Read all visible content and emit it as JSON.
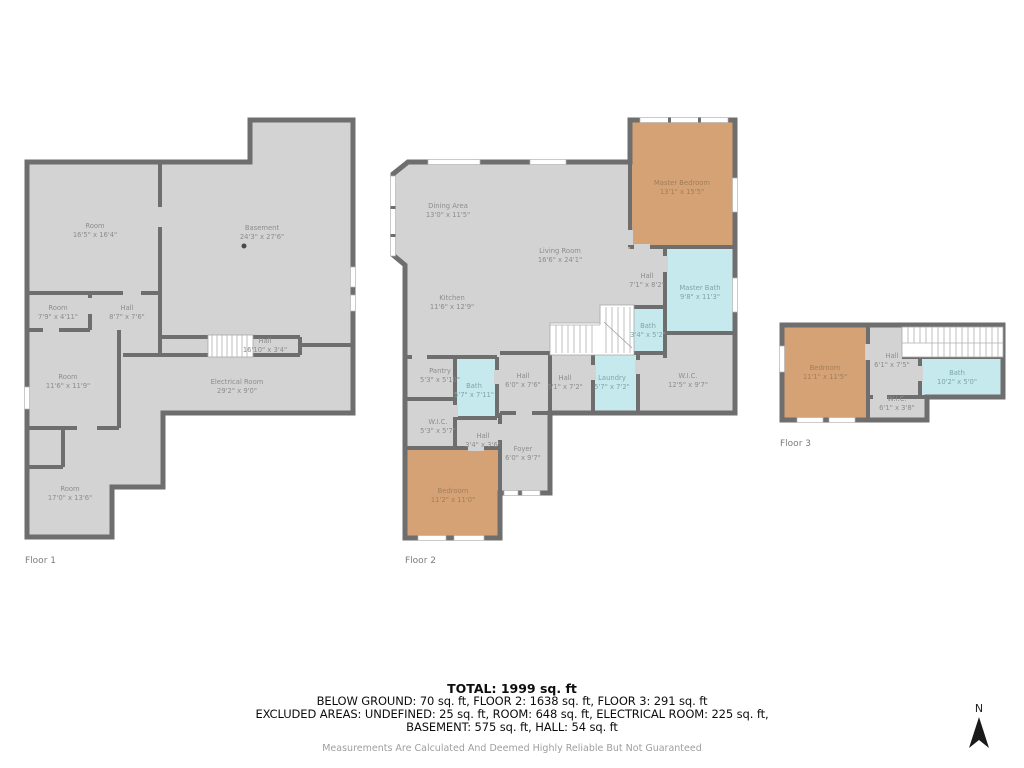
{
  "page": {
    "background": "#ffffff"
  },
  "colors": {
    "wall": "#6e6e6e",
    "room_fill": "#d3d3d3",
    "bedroom_fill": "#d5a276",
    "bath_fill": "#c6e9ed",
    "stair_fill": "#ffffff",
    "label_text": "#8d8d8d",
    "summary_text": "#0d0d0d",
    "disclaimer_text": "#9e9e9e"
  },
  "floors": [
    {
      "caption": "Floor 1",
      "rooms": [
        {
          "name": "Room",
          "dims": "16'5\" x 16'4\""
        },
        {
          "name": "Basement",
          "dims": "24'3\" x 27'6\""
        },
        {
          "name": "Room",
          "dims": "7'9\" x 4'11\""
        },
        {
          "name": "Hall",
          "dims": "8'7\" x 7'6\""
        },
        {
          "name": "Hall",
          "dims": "16'10\" x 3'4\""
        },
        {
          "name": "Room",
          "dims": "11'6\" x 11'9\""
        },
        {
          "name": "Electrical Room",
          "dims": "29'2\" x 9'0\""
        },
        {
          "name": "Room",
          "dims": "17'0\" x 13'6\""
        }
      ]
    },
    {
      "caption": "Floor 2",
      "rooms": [
        {
          "name": "Dining Area",
          "dims": "13'0\" x 11'5\""
        },
        {
          "name": "Living Room",
          "dims": "16'6\" x 24'1\""
        },
        {
          "name": "Kitchen",
          "dims": "11'6\" x 12'9\""
        },
        {
          "name": "Master Bedroom",
          "dims": "13'1\" x 15'5\""
        },
        {
          "name": "Hall",
          "dims": "7'1\" x 8'2\""
        },
        {
          "name": "Master Bath",
          "dims": "9'8\" x 11'3\""
        },
        {
          "name": "Bath",
          "dims": "3'4\" x 5'2\""
        },
        {
          "name": "W.I.C.",
          "dims": "12'5\" x 9'7\""
        },
        {
          "name": "Laundry",
          "dims": "5'7\" x 7'2\""
        },
        {
          "name": "Hall",
          "dims": "5'1\" x 7'2\""
        },
        {
          "name": "Hall",
          "dims": "6'0\" x 7'6\""
        },
        {
          "name": "Pantry",
          "dims": "5'3\" x 5'10\""
        },
        {
          "name": "Bath",
          "dims": "5'7\" x 7'11\""
        },
        {
          "name": "W.I.C.",
          "dims": "5'3\" x 5'7\""
        },
        {
          "name": "Hall",
          "dims": "3'4\" x 3'6\""
        },
        {
          "name": "Foyer",
          "dims": "6'0\" x 9'7\""
        },
        {
          "name": "Bedroom",
          "dims": "11'2\" x 11'0\""
        }
      ]
    },
    {
      "caption": "Floor 3",
      "rooms": [
        {
          "name": "Bedroom",
          "dims": "11'1\" x 11'5\""
        },
        {
          "name": "Hall",
          "dims": "6'1\" x 7'5\""
        },
        {
          "name": "Bath",
          "dims": "10'2\" x 5'0\""
        },
        {
          "name": "W.I.C.",
          "dims": "6'1\" x 3'8\""
        }
      ]
    }
  ],
  "summary": {
    "total": "TOTAL: 1999 sq. ft",
    "line1": "BELOW GROUND: 70 sq. ft, FLOOR 2: 1638 sq. ft, FLOOR 3: 291 sq. ft",
    "line2": "EXCLUDED AREAS: UNDEFINED: 25 sq. ft, ROOM: 648 sq. ft, ELECTRICAL ROOM: 225 sq. ft,",
    "line3": "BASEMENT: 575 sq. ft, HALL: 54 sq. ft",
    "disclaimer": "Measurements Are Calculated And Deemed Highly Reliable But Not Guaranteed"
  },
  "compass": {
    "label": "N"
  }
}
